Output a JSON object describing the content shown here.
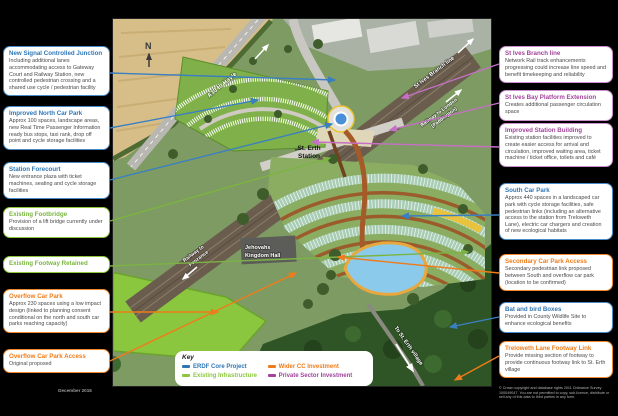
{
  "page": {
    "date": "December 2016",
    "copyright": "© Crown copyright and database rights 2011 Ordnance Survey 100049047. You are not permitted to copy, sub-licence, distribute or sell any of this data to third parties in any form."
  },
  "colors": {
    "erdf_blue": "#2f76b5",
    "existing_green": "#8cc63f",
    "wider_cc_orange": "#ef7c1a",
    "private_purple": "#a1449c"
  },
  "left_boxes": [
    {
      "color": "blue",
      "title": "New Signal Controlled Junction",
      "body": "Including additional lanes accommodating access to Gateway Court and Railway Station, new controlled pedestrian crossing and a shared use cycle / pedestrian facility"
    },
    {
      "color": "blue",
      "title": "Improved North Car Park",
      "body": "Approx 100 spaces, landscape areas, new Real Time Passenger Information ready bus stops, taxi rank, drop off point and cycle storage facilities"
    },
    {
      "color": "blue",
      "title": "Station Forecourt",
      "body": "New entrance plaza with ticket machines, seating and cycle storage facilities"
    },
    {
      "color": "green",
      "title": "Existing Footbridge",
      "body": "Provision of a lift bridge currently under discussion"
    },
    {
      "color": "green",
      "title": "Existing Footway Retained",
      "body": ""
    },
    {
      "color": "orange",
      "title": "Overflow Car Park",
      "body": "Approx 230 spaces using a low impact design (linked to planning consent conditional on the north and south car parks reaching capacity)"
    },
    {
      "color": "orange",
      "title": "Overflow Car Park Access",
      "body": "Original proposed"
    }
  ],
  "right_boxes": [
    {
      "color": "purple",
      "title": "St Ives Branch line",
      "body": "Network Rail track enhancements progressing could increase line speed and benefit timekeeping and reliability"
    },
    {
      "color": "purple",
      "title": "St Ives Bay Platform Extension",
      "body": "Creates additional passenger circulation space"
    },
    {
      "color": "purple",
      "title": "Improved Station Building",
      "body": "Existing station facilities improved to create easier access for arrival and circulation, improved waiting area, ticket machine / ticket office, toilets and café"
    },
    {
      "color": "blue",
      "title": "South Car Park",
      "body": "Approx 440 spaces in a landscaped car park with cycle storage facilities, safe pedestrian links (including an alternative access to the station from Treloweth Lane), electric car chargers and creation of new ecological habitats"
    },
    {
      "color": "orange",
      "title": "Secondary Car Park Access",
      "body": "Secondary pedestrian link proposed between South and overflow car park (location to be confirmed)"
    },
    {
      "color": "blue",
      "title": "Bat and bird Boxes",
      "body": "Provided in County Wildlife Site to enhance ecological benefits"
    },
    {
      "color": "orange",
      "title": "Treloweth Lane Footway Link",
      "body": "Provide missing section of footway to provide continuous footway link to St. Erth village"
    }
  ],
  "key": {
    "title": "Key",
    "items": [
      {
        "label": "ERDF Core Project",
        "color": "#2f76b5"
      },
      {
        "label": "Existing Infrastructure",
        "color": "#8cc63f"
      },
      {
        "label": "Wider CC Investment",
        "color": "#ef7c1a"
      },
      {
        "label": "Private Sector Investment",
        "color": "#a1449c"
      }
    ]
  },
  "map": {
    "labels": {
      "north": "N",
      "a30": "A30 to Hayle",
      "st_ives": "St Ives Branch line",
      "london_1": "Railway to London",
      "london_2": "(Paddington)",
      "penzance_1": "Railway to",
      "penzance_2": "Penzance",
      "station_1": "St. Erth",
      "station_2": "Station",
      "hall_1": "Jehovahs",
      "hall_2": "Kingdom Hall",
      "village": "To St. Erth village"
    }
  }
}
